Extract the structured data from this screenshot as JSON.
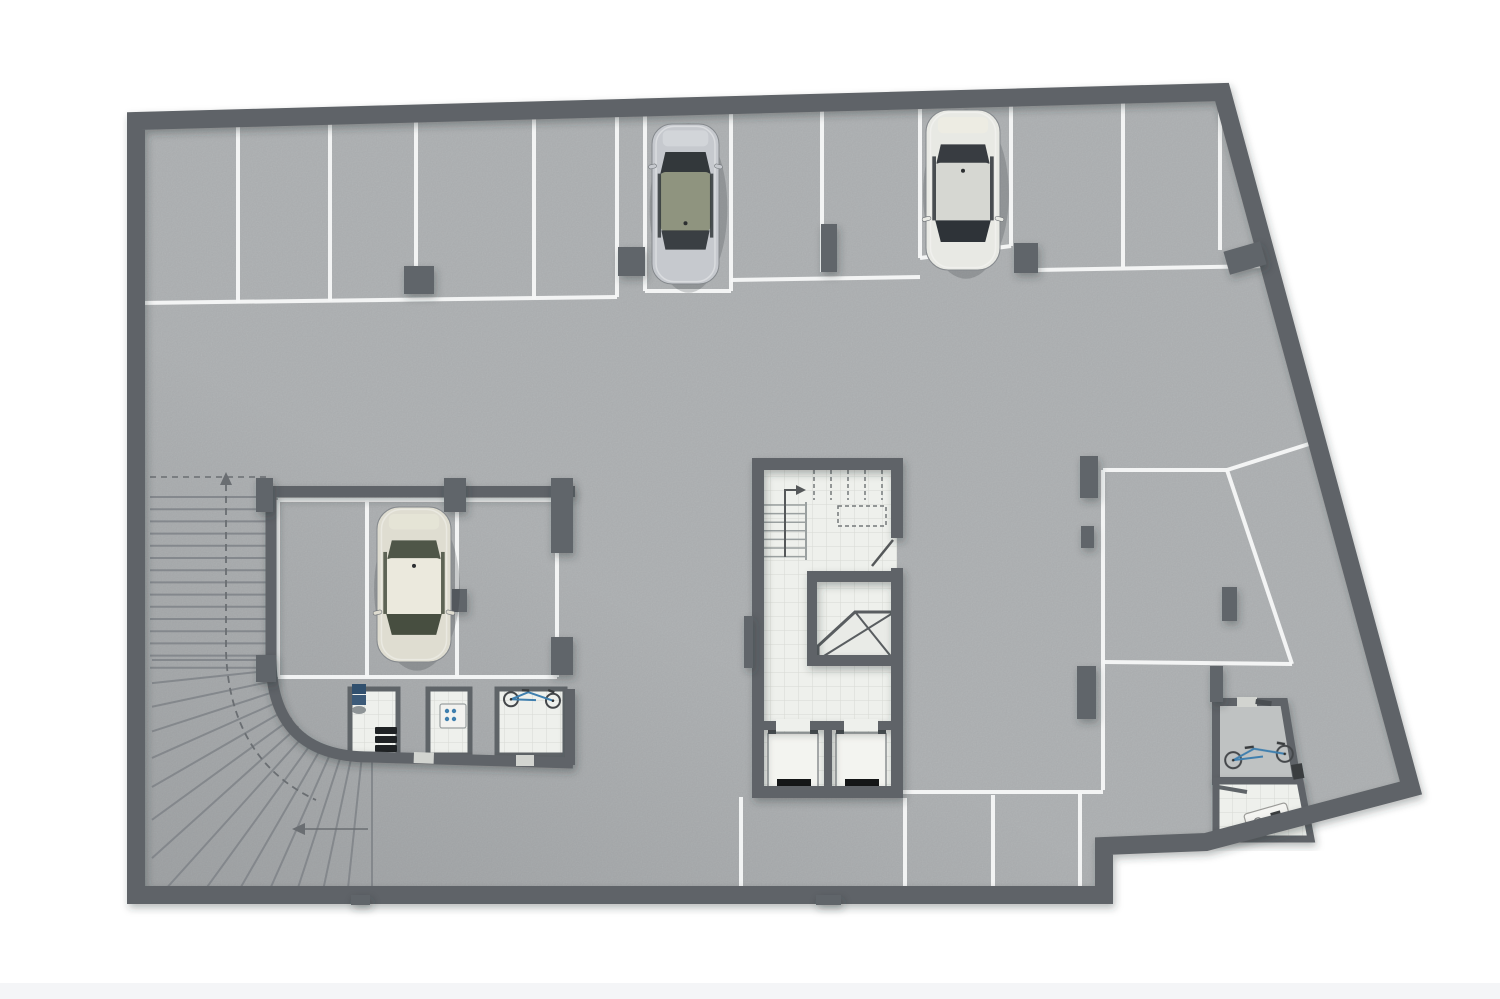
{
  "scene": {
    "type": "architectural-floor-plan",
    "subject": "underground parking garage basement level, top-down 3D render",
    "visible_text": "none"
  },
  "palette": {
    "outside": "#ffffff",
    "floor": "#b6b9bb",
    "floor-room": "#bfc2c2",
    "wall": "#5f6468",
    "wall2": "#60656a",
    "line": "#f7f8f8",
    "tile": "#eef0ec",
    "tile-line": "#d7d9d3",
    "tread": "#81858a",
    "dash": "#6a6e72",
    "accent": "#3f7fae",
    "door": "#d2d4d0",
    "black": "#141617",
    "band": "#f4f5f7"
  },
  "inventory": {
    "cars_parked": 3,
    "bicycles": 2,
    "elevators": 2,
    "stairways": 1,
    "curved_ramps": 1,
    "storage_rooms": 3,
    "utility_rooms": 2,
    "top_row_stalls": 11,
    "garage_box_stalls": 3,
    "right_side_stalls": 2,
    "bottom_row_stalls": 4
  },
  "plan": {
    "stall_lines": [
      [
        238,
        122,
        238,
        303
      ],
      [
        330,
        121,
        330,
        301
      ],
      [
        416,
        120,
        416,
        292
      ],
      [
        534,
        118,
        534,
        299
      ],
      [
        617,
        117,
        617,
        297
      ],
      [
        645,
        113,
        645,
        291
      ],
      [
        731,
        111,
        731,
        291
      ],
      [
        822,
        108,
        822,
        272
      ],
      [
        920,
        106,
        920,
        258
      ],
      [
        1011,
        96,
        1011,
        246
      ],
      [
        1123,
        94,
        1123,
        267
      ],
      [
        1220,
        91,
        1220,
        250
      ],
      [
        140,
        303,
        617,
        297
      ],
      [
        645,
        291,
        731,
        291
      ],
      [
        731,
        280,
        920,
        277
      ],
      [
        920,
        258,
        1011,
        246
      ],
      [
        1037,
        270,
        1270,
        266
      ],
      [
        633,
        109,
        1222,
        94
      ],
      [
        1228,
        101,
        1403,
        783
      ],
      [
        278,
        500,
        557,
        500
      ],
      [
        278,
        677,
        557,
        677
      ],
      [
        278,
        500,
        278,
        677
      ],
      [
        557,
        500,
        557,
        677
      ],
      [
        367,
        500,
        367,
        677
      ],
      [
        457,
        500,
        457,
        677
      ],
      [
        1103,
        470,
        1103,
        790
      ],
      [
        903,
        792,
        1103,
        792
      ],
      [
        1103,
        470,
        1227,
        470
      ],
      [
        1227,
        470,
        1292,
        664
      ],
      [
        1103,
        662,
        1292,
        664
      ],
      [
        1227,
        470,
        1312,
        443
      ],
      [
        1107,
        845,
        1206,
        841
      ],
      [
        1206,
        841,
        1402,
        786
      ],
      [
        741,
        797,
        741,
        896
      ],
      [
        905,
        798,
        905,
        896
      ],
      [
        993,
        795,
        993,
        896
      ],
      [
        1080,
        793,
        1080,
        896
      ],
      [
        742,
        896,
        1098,
        896
      ]
    ],
    "columns": [
      [
        404,
        266,
        30,
        28
      ],
      [
        618,
        247,
        27,
        29
      ],
      [
        821,
        224,
        16,
        48
      ],
      [
        1014,
        243,
        24,
        30
      ],
      [
        1226,
        246,
        38,
        24,
        -16
      ],
      [
        1080,
        456,
        18,
        42
      ],
      [
        1081,
        526,
        13,
        22
      ],
      [
        1077,
        666,
        19,
        53
      ],
      [
        1222,
        587,
        15,
        34
      ],
      [
        1210,
        666,
        13,
        36
      ],
      [
        816,
        895,
        25,
        10
      ],
      [
        351,
        895,
        19,
        10
      ],
      [
        256,
        478,
        17,
        34
      ],
      [
        444,
        478,
        22,
        34
      ],
      [
        452,
        589,
        15,
        23
      ],
      [
        551,
        637,
        22,
        38
      ],
      [
        256,
        655,
        20,
        27
      ],
      [
        551,
        478,
        22,
        75
      ],
      [
        744,
        616,
        9,
        52
      ]
    ],
    "ramp": {
      "treads": {
        "x1": 150,
        "x2": 268,
        "y0": 497,
        "step": 12.2,
        "count": 15
      },
      "fan": {
        "cx": 372,
        "cy": 660,
        "r": 99,
        "count": 16,
        "min_x": 152,
        "max_y": 893
      }
    },
    "cars": [
      {
        "id": "car-silver-hatchback",
        "front": "up",
        "x": 652,
        "y": 124,
        "w": 67,
        "h": 160,
        "body": "#c6c9ce",
        "roof": "#8f947f",
        "glass": "#33383b",
        "deck": "#d3d6da"
      },
      {
        "id": "car-white-sedan",
        "front": "down",
        "x": 926,
        "y": 110,
        "w": 74,
        "h": 160,
        "body": "#e8e9e4",
        "roof": "#d6d7d2",
        "glass": "#2e3338",
        "deck": "#edece2"
      },
      {
        "id": "car-cream-suv",
        "front": "down",
        "x": 377,
        "y": 507,
        "w": 74,
        "h": 155,
        "body": "#dfddd1",
        "roof": "#ebe9dd",
        "glass": "#474e40",
        "deck": "#e6e4d6"
      }
    ],
    "bikes": [
      {
        "id": "bicycle-storage-room",
        "x": 532,
        "y": 700,
        "gap": 21,
        "r": 7,
        "rot": 2
      },
      {
        "id": "bicycle-utility-room",
        "x": 1259,
        "y": 757,
        "gap": 26,
        "r": 8,
        "rot": -7
      }
    ]
  }
}
